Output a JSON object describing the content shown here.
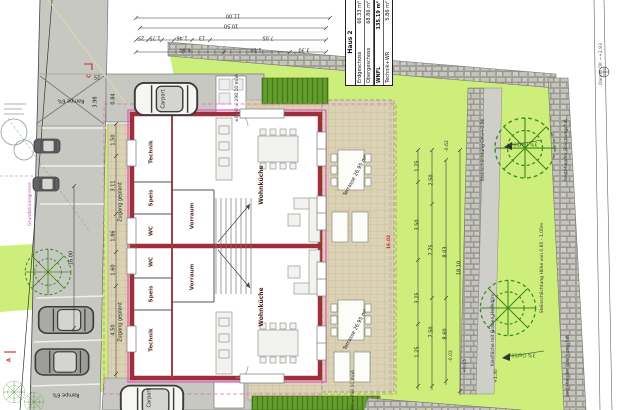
{
  "legend": {
    "title": "Haus 2",
    "rows": [
      {
        "label": "Erdgeschoss",
        "value": "66.33 m²"
      },
      {
        "label": "Obergeschoss",
        "value": "68.86 m²"
      },
      {
        "label": "WNFL",
        "value": "135.19 m²"
      },
      {
        "label": "Technik+WR",
        "value": "5.86 m²"
      }
    ]
  },
  "rooms": {
    "wohnkueche": "Wohnküche",
    "technik": "Technik",
    "speis": "Speis",
    "wc": "WC",
    "vorraum": "Vorraum"
  },
  "site": {
    "zugang": "Zugang geplant",
    "carport": "Carport",
    "rampe": "Rampe 6%",
    "terrasse": "Terrasse 26.95 m²",
    "gefaelle": "3% Gefälle",
    "stein_hoehe": "Steinschlichtung Höhe von 0.60 - 1.00m",
    "stein_ok": "Steinschlichtung OK=+0.50",
    "kies": "Kiesfläche mit Graben H=0.40m",
    "boeschung": "bestehender Böschungsfuß",
    "damm": "Damm OK ~+2.93",
    "grenze": "Grundstücksgrenze",
    "elev": "±0.00 = 298.10 müA"
  },
  "markers": {
    "section_c": "C",
    "view_a": "A",
    "m_062": "-0.62",
    "m_002": "-0.02",
    "m_015": "+0.15",
    "m_130": "+1.30"
  },
  "dims": {
    "top": {
      "a": "11.00",
      "b": "10.50",
      "c": "25",
      "d": "1.75",
      "e": "1.46",
      "f": "13",
      "g": "7.05",
      "h": "6.60",
      "i": "1.10",
      "j": "3.30"
    },
    "left": {
      "a": "16.00",
      "b": "1.50",
      "c": "3.11",
      "d": "1.86",
      "e": "1.60",
      "f": "4.50"
    },
    "ramp": {
      "a": "3.98",
      "b": "0.84",
      "c": "25"
    },
    "garden": {
      "a": "1.25",
      "b": "2.50",
      "c": "3.50",
      "d": "7.75",
      "e": "8.03",
      "f": "3.25",
      "g": "7.50",
      "h": "8.60",
      "i": "18.10"
    },
    "red_len": "16.02"
  }
}
